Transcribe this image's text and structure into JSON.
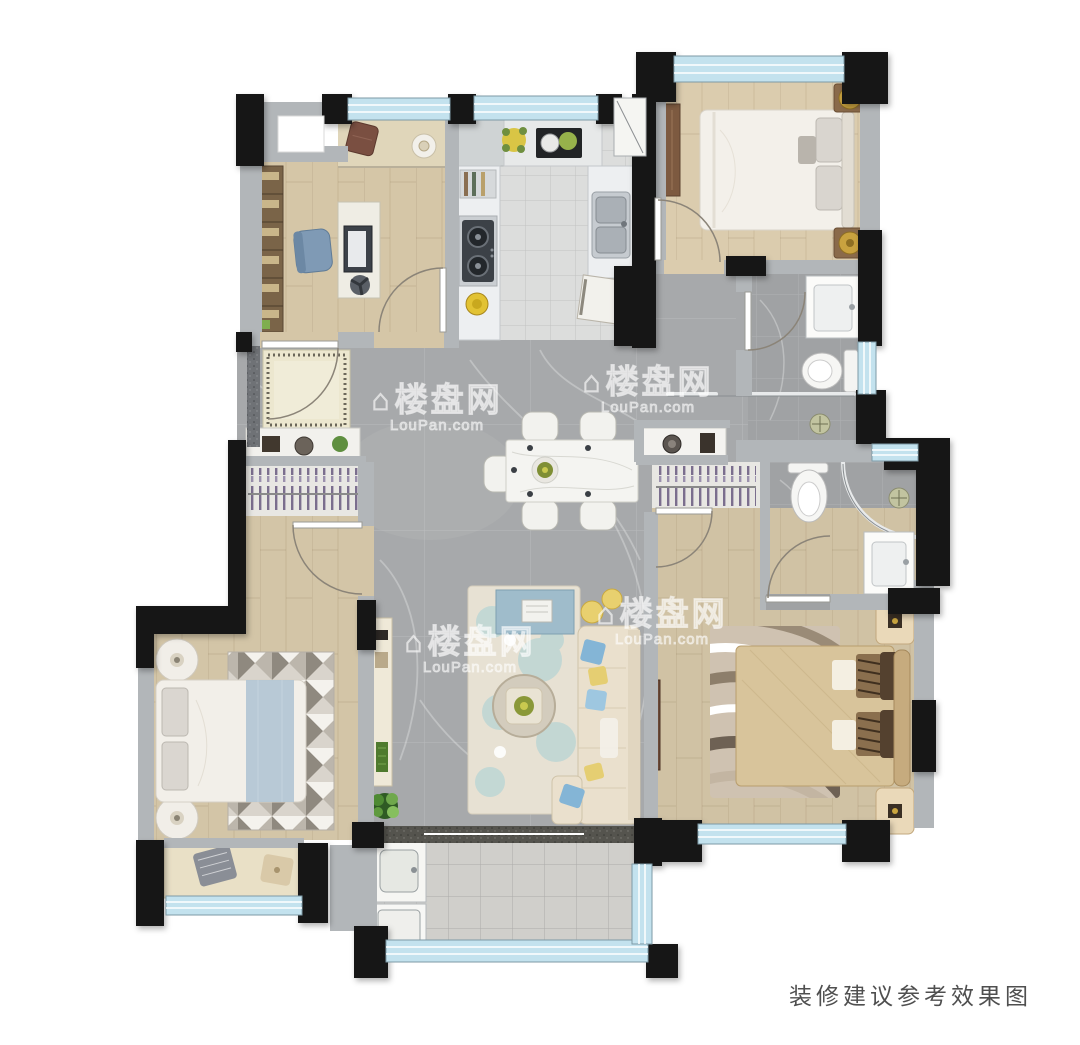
{
  "caption": "装修建议参考效果图",
  "watermark": {
    "brand": "楼盘网",
    "domain": "LouPan.com",
    "icon": "house-icon",
    "glyph": "⌂"
  },
  "palette": {
    "wall_black": "#161616",
    "wall_gray": "#b2b6b9",
    "window_glass": "#c3e2ee",
    "marble_floor": "#a7a9ab",
    "bath_floor": "#a0a2a4",
    "wood_floor": "#d5c6a7",
    "kitchen_tile": "#dcdddc",
    "balcony_tile": "#d0cfcb",
    "closet_purple": "#7b6e8e",
    "sofa_beige": "#eae0cd",
    "tv_bench_blue": "#9fbccb",
    "pillow_blue": "#84b5d6",
    "pillow_yellow": "#e5ce72",
    "master_bed_tan": "#d8c49b",
    "chair_blue": "#7f9ab5",
    "plant_green": "#5f8f3f",
    "lamp_gold": "#c9a23f"
  }
}
